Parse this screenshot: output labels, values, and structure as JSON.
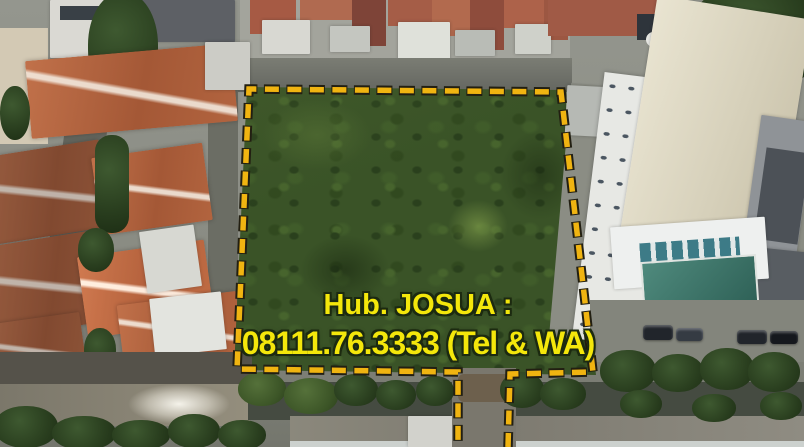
{
  "scene": {
    "kind": "aerial drone photograph",
    "subject": "vacant green land plot marked with dashed boundary for sale"
  },
  "plot_outline": {
    "style": "dashed",
    "color": "#f0b411"
  },
  "overlay_text": {
    "line1": "Hub. JOSUA :",
    "line2": "08111.76.3333 (Tel & WA)",
    "color": "#f4e70b"
  }
}
